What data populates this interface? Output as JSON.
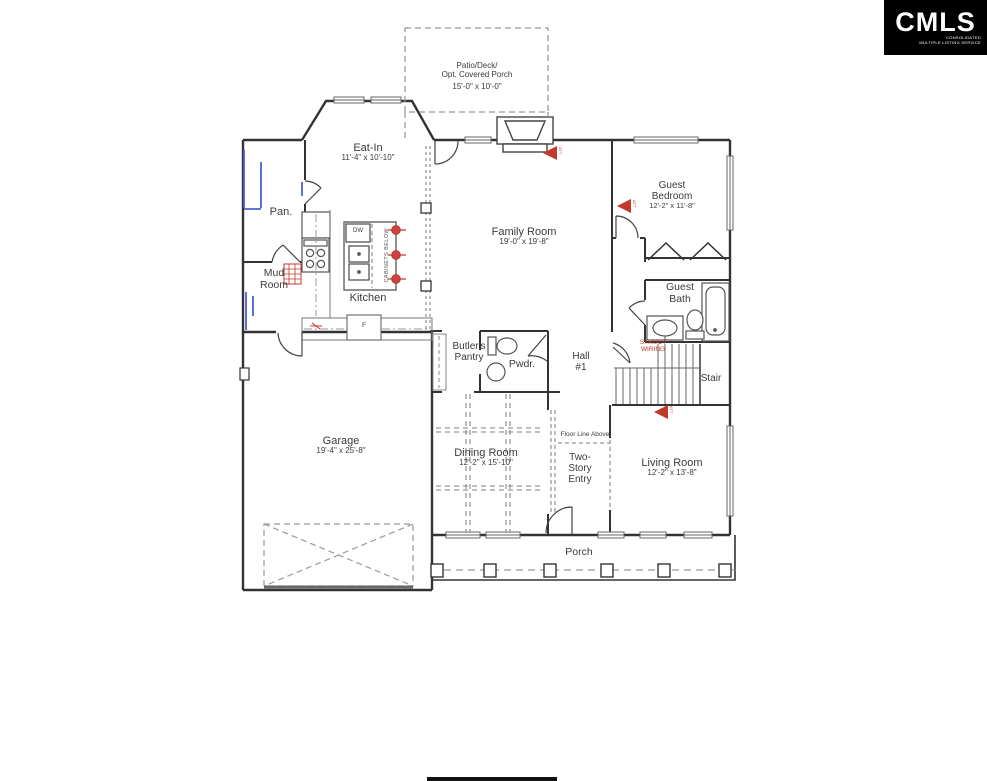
{
  "logo": {
    "title": "CMLS",
    "subtitle1": "CONSOLIDATED",
    "subtitle2": "MULTIPLE LISTING SERVICE"
  },
  "rooms": {
    "patio": {
      "line1": "Patio/Deck/",
      "line2": "Opt. Covered Porch",
      "dims": "15'-0\" x 10'-0\""
    },
    "eat_in": {
      "name": "Eat-In",
      "dims": "11'-4\" x 10'-10\""
    },
    "family_room": {
      "name": "Family Room",
      "dims": "19'-0\" x 19'-8\""
    },
    "guest_bedroom": {
      "line1": "Guest",
      "line2": "Bedroom",
      "dims": "12'-2\" x 11'-8\""
    },
    "guest_bath": {
      "line1": "Guest",
      "line2": "Bath"
    },
    "pantry": {
      "name": "Pan."
    },
    "kitchen": {
      "name": "Kitchen"
    },
    "mud_room": {
      "line1": "Mud",
      "line2": "Room"
    },
    "butlers_pantry": {
      "line1": "Butler's",
      "line2": "Pantry"
    },
    "powder": {
      "name": "Pwdr."
    },
    "hall": {
      "line1": "Hall",
      "line2": "#1"
    },
    "stair": {
      "name": "Stair"
    },
    "garage": {
      "name": "Garage",
      "dims": "19'-4\" x 25'-8\""
    },
    "dining_room": {
      "name": "Dining Room",
      "dims": "12'-2\" x 15'-10\""
    },
    "two_story_entry": {
      "line1": "Two-",
      "line2": "Story",
      "line3": "Entry"
    },
    "living_room": {
      "name": "Living Room",
      "dims": "12'-2\" x 13'-8\""
    },
    "porch": {
      "name": "Porch"
    }
  },
  "annotations": {
    "floor_line": "Floor Line Above",
    "dw": "DW",
    "cabinets_below": "CABINETS BELOW",
    "fridge": "F",
    "struct_wiring_1": "STRUCT",
    "struct_wiring_2": "WIRING",
    "att": "ATT"
  },
  "colors": {
    "wall": "#333333",
    "fixture": "#555555",
    "dashed": "#999999",
    "marker_red": "#c0392b",
    "plumbing_blue": "#4a5fd0",
    "logo_bg": "#000000"
  }
}
